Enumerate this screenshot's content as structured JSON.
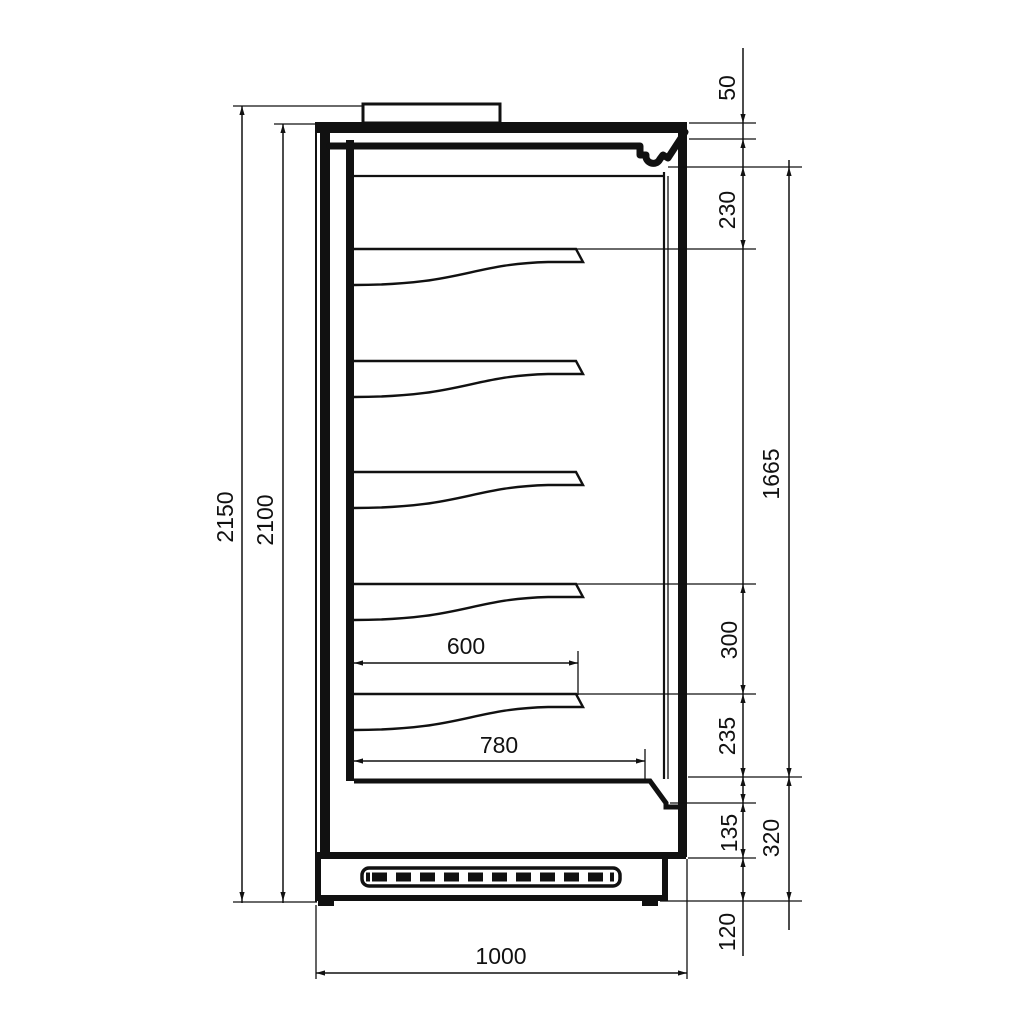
{
  "drawing": {
    "type": "refrigerated-multideck-cabinet-side-section",
    "units": "mm"
  },
  "dims": {
    "overall_height": "2150",
    "body_height": "2100",
    "canopy_top_band": "50",
    "canopy_front": "230",
    "display_opening": "1665",
    "shelf_pitch": "300",
    "bottom_shelf_to_deck": "235",
    "front_panel": "135",
    "plinth": "120",
    "base_section": "320",
    "shelf_depth": "600",
    "deck_depth": "780",
    "overall_depth": "1000"
  }
}
